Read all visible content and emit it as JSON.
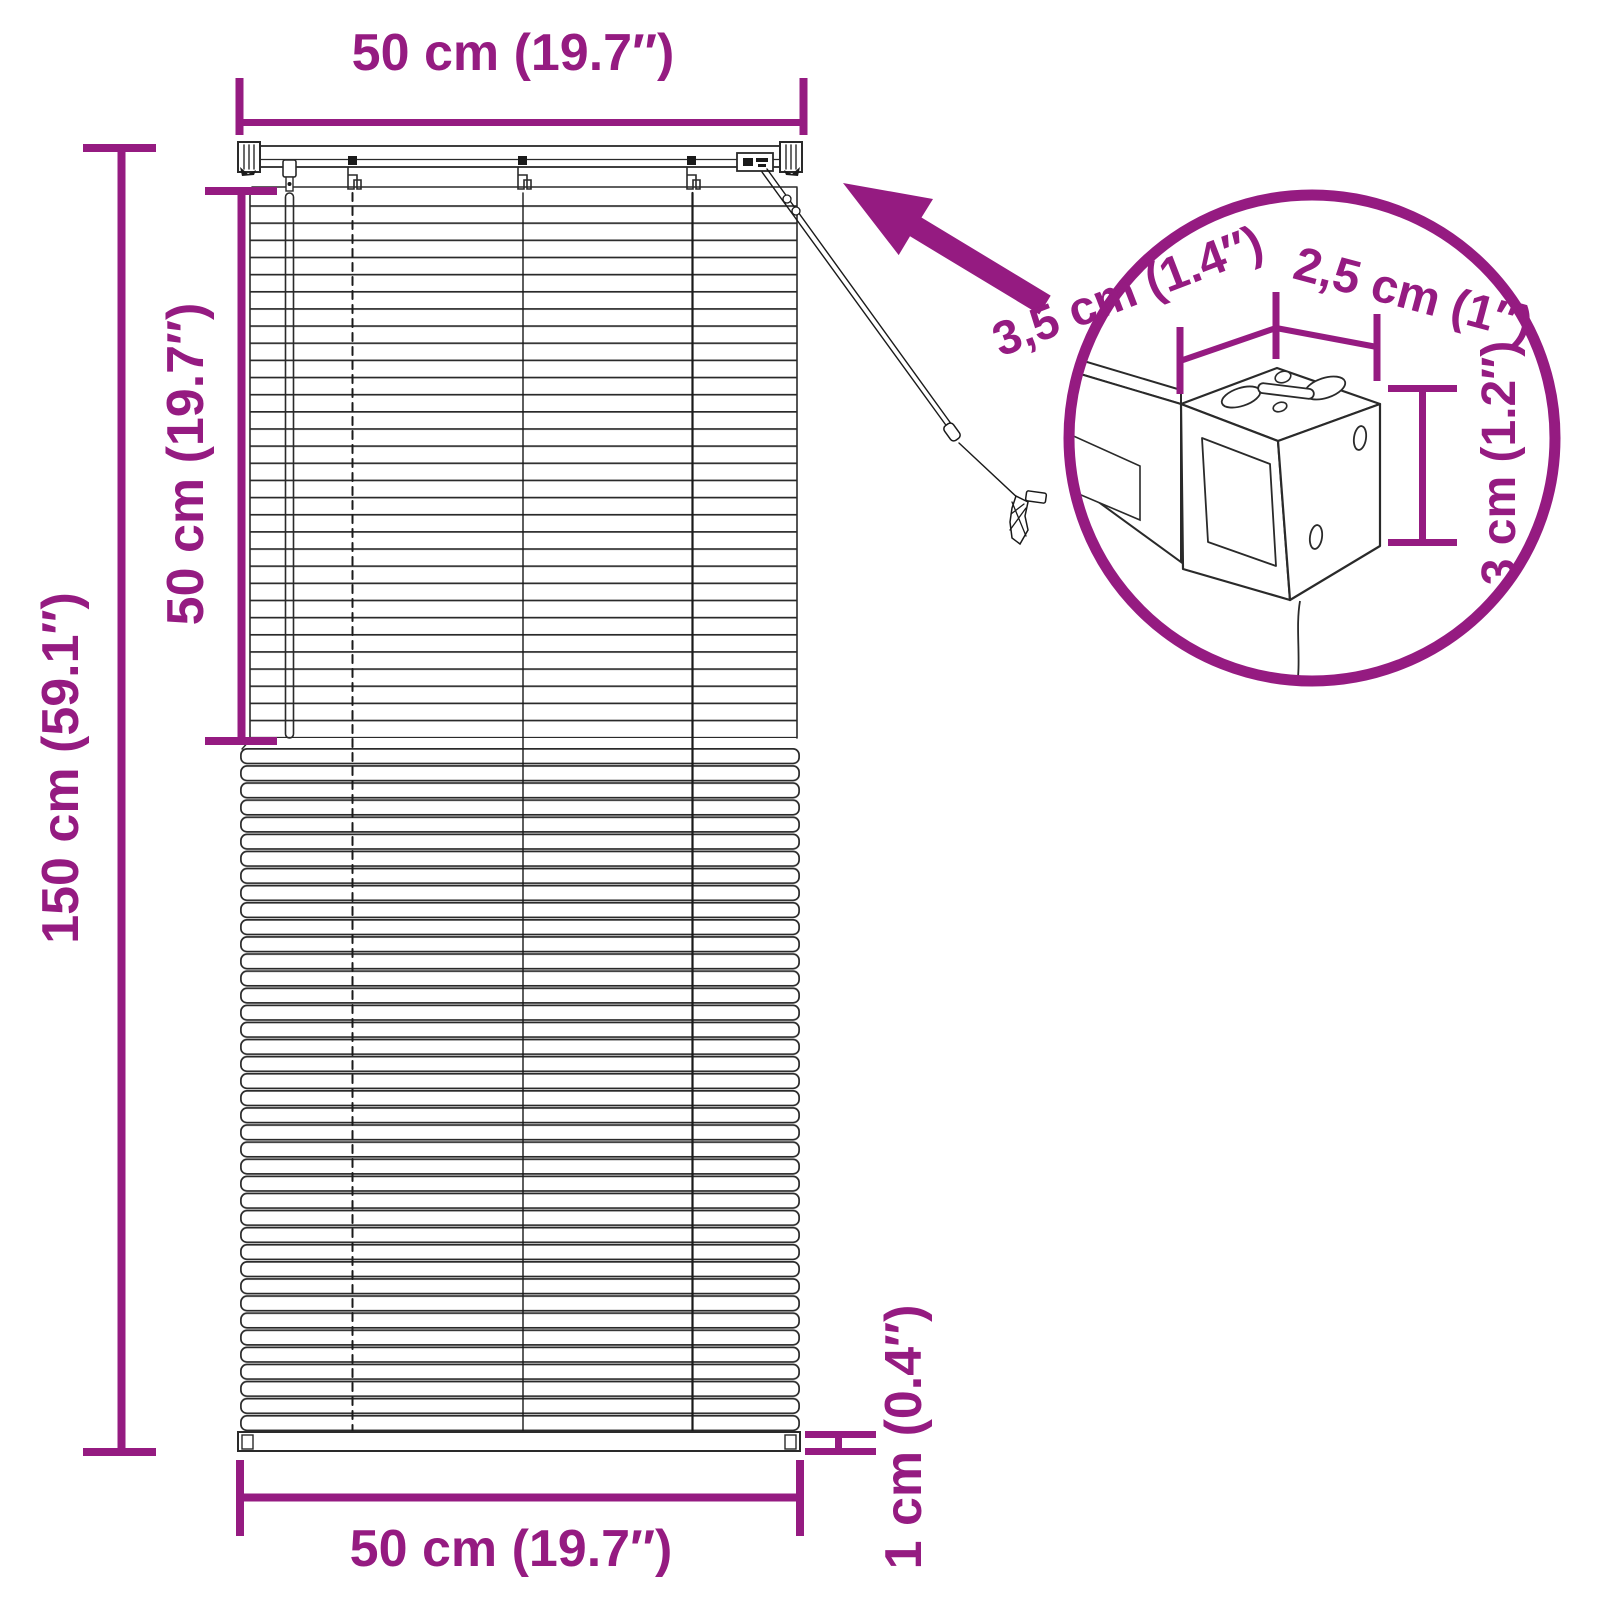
{
  "figure": {
    "type": "product-dimension-diagram",
    "subject": "venetian blind with mounting bracket detail",
    "background": "#ffffff",
    "accent_color": "#951B81",
    "line_color": "#2a2a2a"
  },
  "labels": {
    "top_width": "50 cm (19.7″)",
    "left_height": "150 cm (59.1″)",
    "open_section_height": "50 cm (19.7″)",
    "bottom_width": "50 cm (19.7″)",
    "bottom_rail_height": "1 cm (0.4″)",
    "bracket_depth": "3,5 cm (1.4″)",
    "bracket_width": "2,5 cm (1″)",
    "bracket_height": "3 cm (1.2″)"
  },
  "icons": [
    {
      "name": "zoom-arrow-icon",
      "meaning": "arrow pointing from bracket detail circle to headrail"
    },
    {
      "name": "detail-circle",
      "meaning": "magnified view of mounting bracket on headrail"
    }
  ]
}
